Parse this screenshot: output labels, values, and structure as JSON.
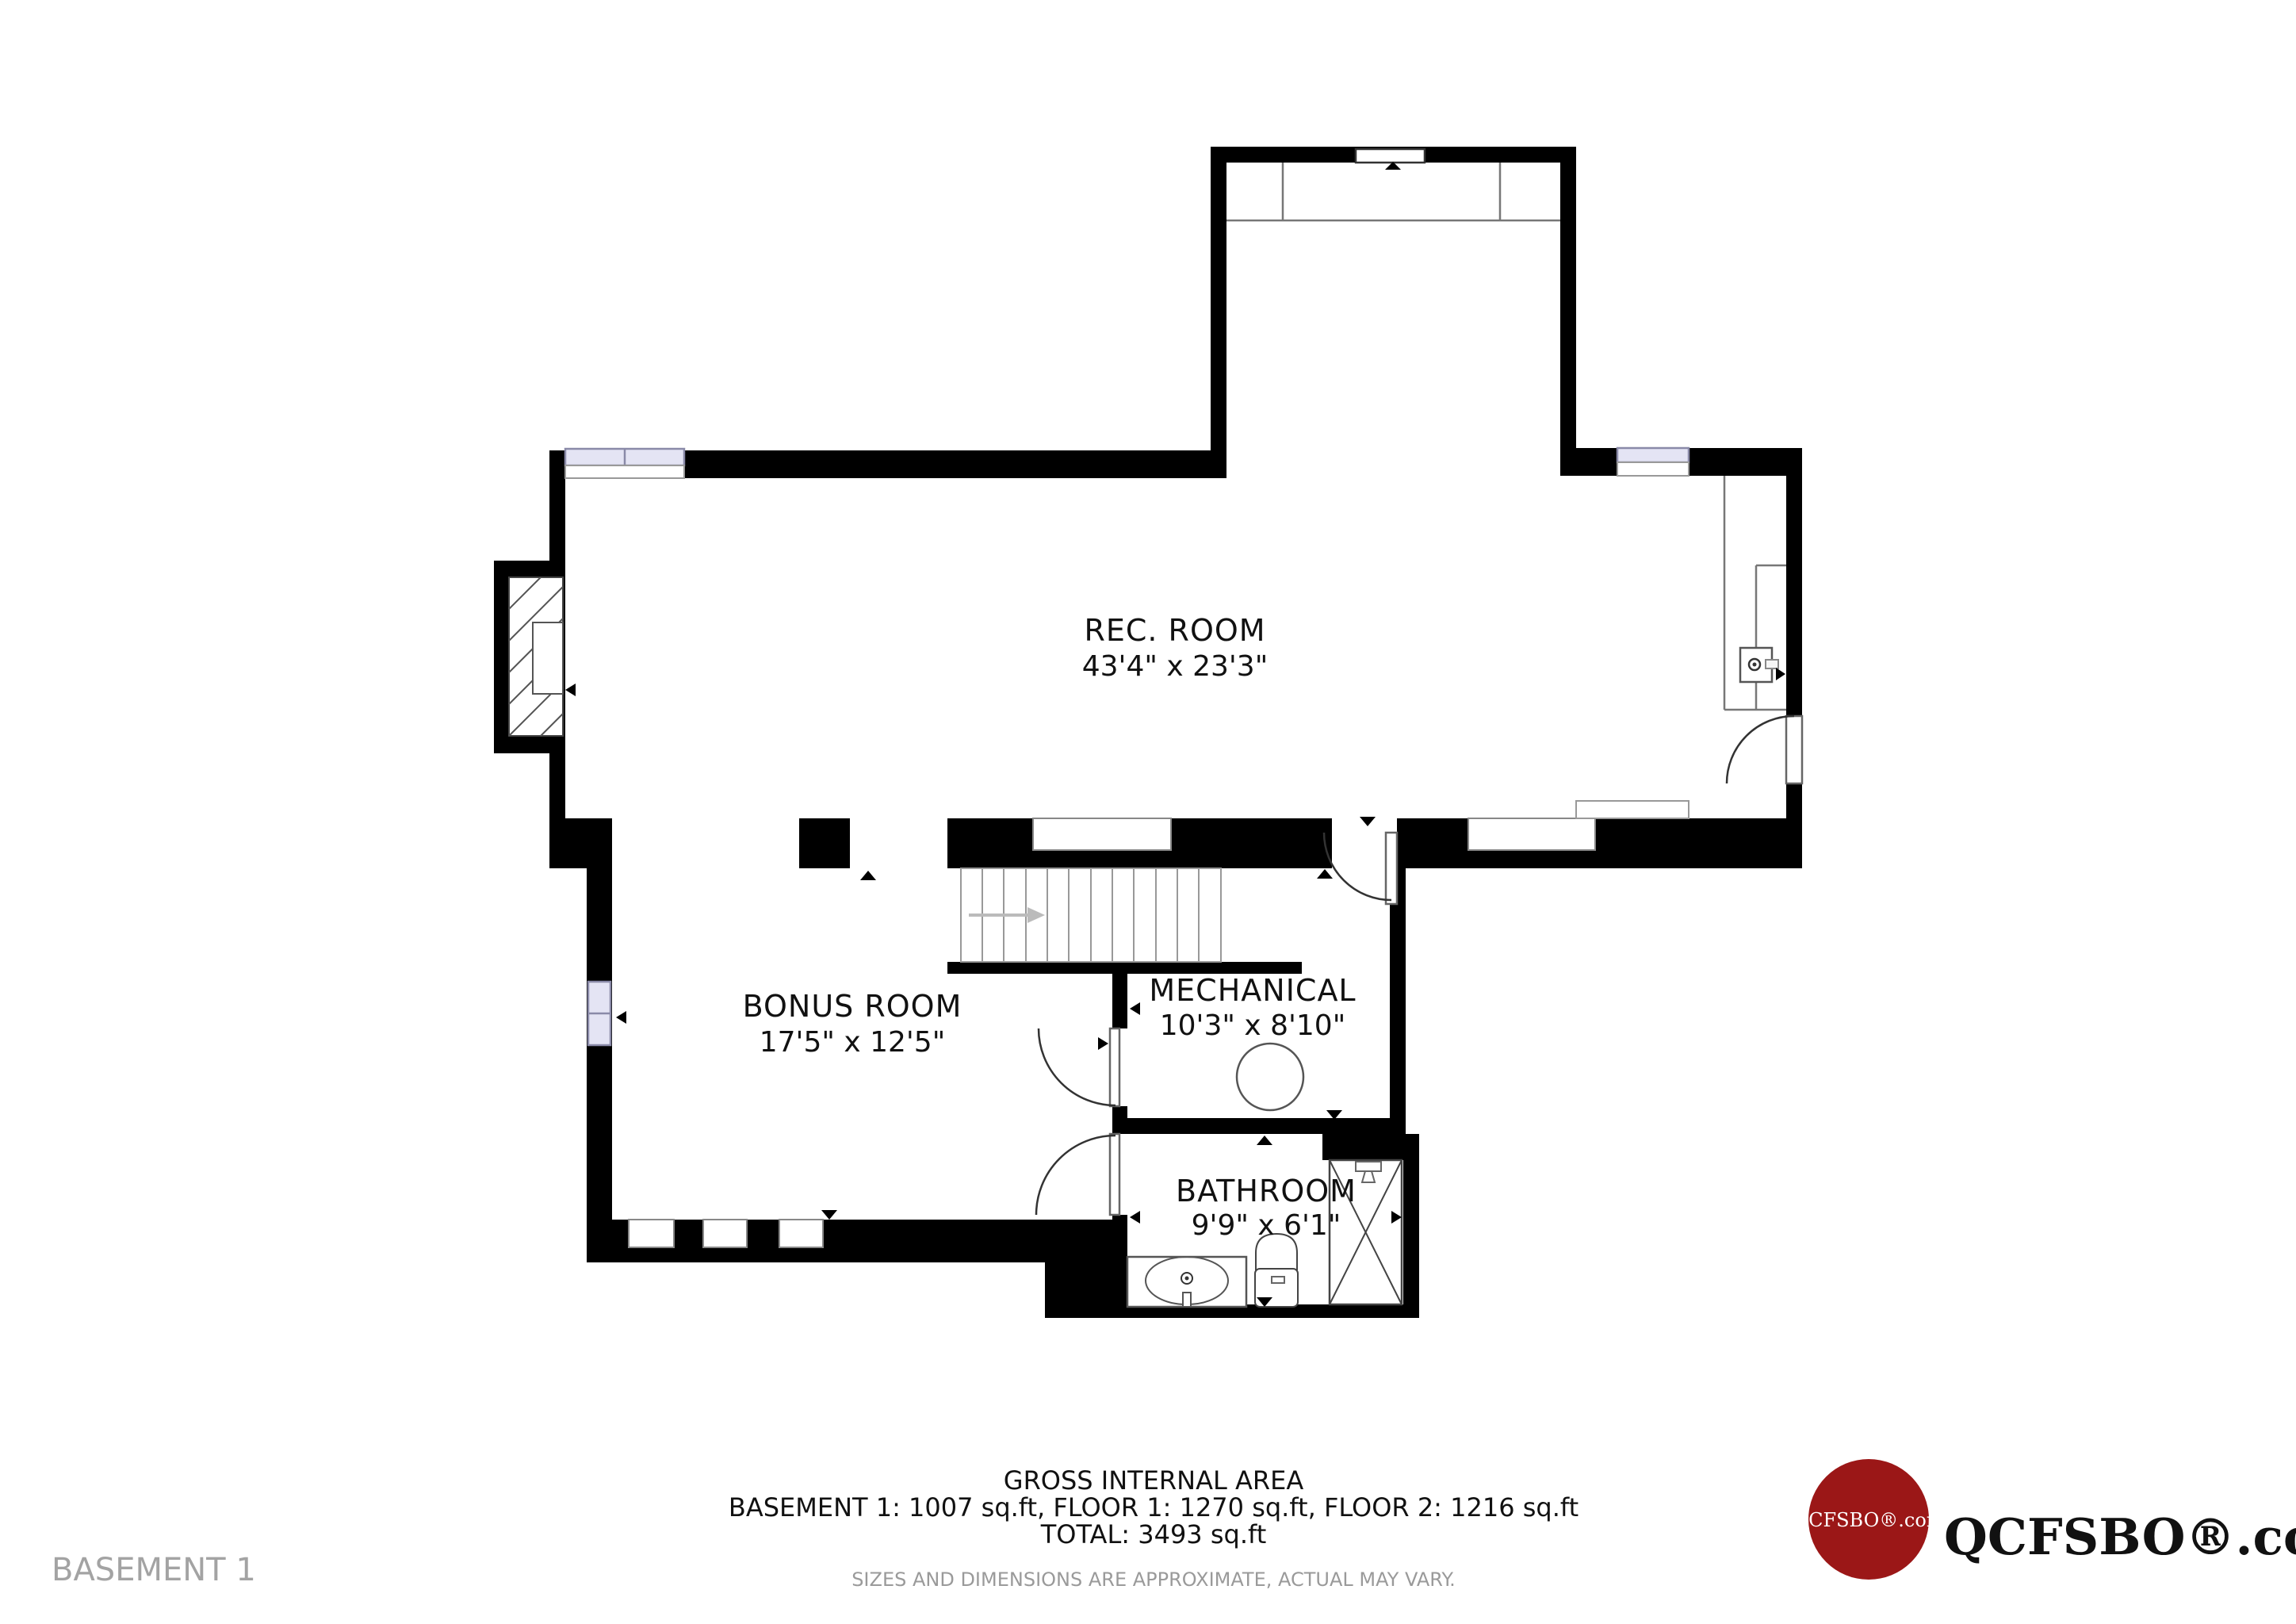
{
  "floor_label": "BASEMENT 1",
  "rooms": [
    {
      "id": "rec-room",
      "name": "REC. ROOM",
      "dims": "43'4\" x 23'3\""
    },
    {
      "id": "bonus-room",
      "name": "BONUS ROOM",
      "dims": "17'5\" x 12'5\""
    },
    {
      "id": "mechanical",
      "name": "MECHANICAL",
      "dims": "10'3\" x 8'10\""
    },
    {
      "id": "bathroom",
      "name": "BATHROOM",
      "dims": "9'9\" x 6'1\""
    }
  ],
  "footer": {
    "title": "GROSS INTERNAL AREA",
    "areas": "BASEMENT 1: 1007 sq.ft, FLOOR 1: 1270 sq.ft, FLOOR 2: 1216 sq.ft",
    "total": "TOTAL: 3493 sq.ft",
    "disclaimer": "SIZES AND DIMENSIONS ARE APPROXIMATE, ACTUAL MAY VARY."
  },
  "logo": {
    "badge_text": "QCFSBO®.com",
    "brand_text": "QCFSBO®.com",
    "badge_color": "#9b1717"
  },
  "colors": {
    "wall": "#000000",
    "window_glass": "#e4e4f4",
    "muted_label": "#a3a3a3",
    "disclaimer_text": "#9a9a9a",
    "stair_arrow": "#bbbbbb"
  }
}
